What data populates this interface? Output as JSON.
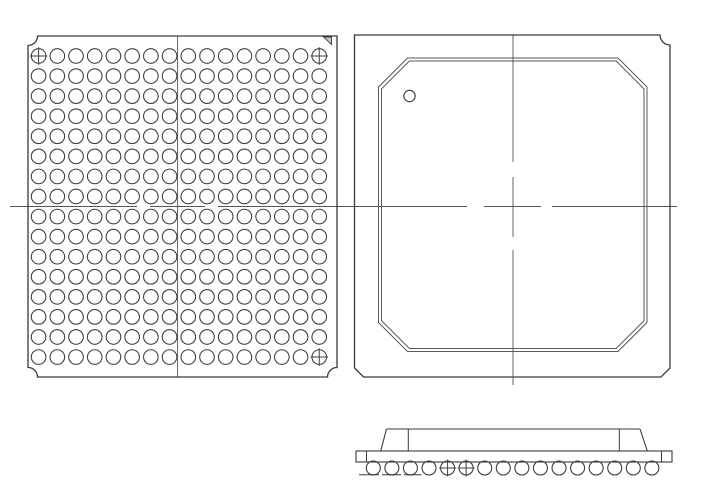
{
  "drawing": {
    "canvas": {
      "width": 701,
      "height": 495
    },
    "colors": {
      "background": "#ffffff",
      "outline": "#3a3a3a",
      "ball": "#404040",
      "centerline": "#555555",
      "cap": "#5a5a5a",
      "triangle_fill": "#c9c9c9"
    },
    "bottom_view": {
      "label": "package-bottom-view-ball-grid",
      "outline": {
        "x": 28,
        "y": 36,
        "width": 309,
        "height": 341,
        "corner_notch_radius": 9.5
      },
      "corner_triangle_points": "323.5,37 331.5,37 331.5,44.5",
      "grid": {
        "rows": 16,
        "cols": 16,
        "start_x": 38.6,
        "start_y": 56,
        "step_x": 18.71,
        "step_y": 20.07,
        "ball_radius": 7.3
      },
      "crosshair_balls": [
        {
          "row": 0,
          "col": 0
        },
        {
          "row": 0,
          "col": 15
        },
        {
          "row": 15,
          "col": 15
        }
      ],
      "crosshair_overhang": 1.5,
      "vertical_centerline": {
        "x": 177.6,
        "segments": [
          [
            36,
            377
          ]
        ]
      }
    },
    "top_view": {
      "label": "package-top-view-body",
      "outline": {
        "x": 354.5,
        "y": 35,
        "width": 315.5,
        "height": 342,
        "corner_notch_radius": 10,
        "bottom_chamfer": 9
      },
      "mold_cap": {
        "left": 378.5,
        "top": 58,
        "right": 647,
        "bottom": 351.5,
        "chamfer": 29,
        "inner_offset": 3
      },
      "pin1_marker": {
        "cx": 409.5,
        "cy": 96,
        "r": 5.7
      },
      "vertical_centerline": {
        "x": 513,
        "segments": [
          [
            35,
            162
          ],
          [
            177,
            237
          ],
          [
            250,
            385
          ]
        ]
      }
    },
    "horizontal_centerline": {
      "y": 206.5,
      "segments": [
        [
          10,
          137
        ],
        [
          150,
          205
        ],
        [
          218,
          467
        ],
        [
          484,
          541
        ],
        [
          552,
          677
        ]
      ]
    },
    "side_view": {
      "label": "package-side-profile",
      "substrate": {
        "x": 356,
        "y": 451,
        "width": 316,
        "height": 11,
        "divider_x": [
          366.5,
          661.5
        ]
      },
      "mold": {
        "top_y": 429,
        "top_x1": 386.5,
        "top_x2": 640,
        "base_y": 451,
        "slope_left_foot_x": 380.7,
        "slope_right_foot_x": 647.3,
        "chamfer_edge_left_x": 408.3,
        "chamfer_edge_right_x": 619.3
      },
      "balls": {
        "count": 16,
        "start_x": 373.3,
        "step_x": 18.57,
        "cy": 468,
        "r": 7,
        "crosshair_indices": [
          4,
          5
        ]
      },
      "seating_marks": {
        "y": 474.8,
        "segments": [
          [
            359,
            379
          ],
          [
            382,
            401
          ],
          [
            404,
            421.5
          ]
        ]
      }
    }
  }
}
